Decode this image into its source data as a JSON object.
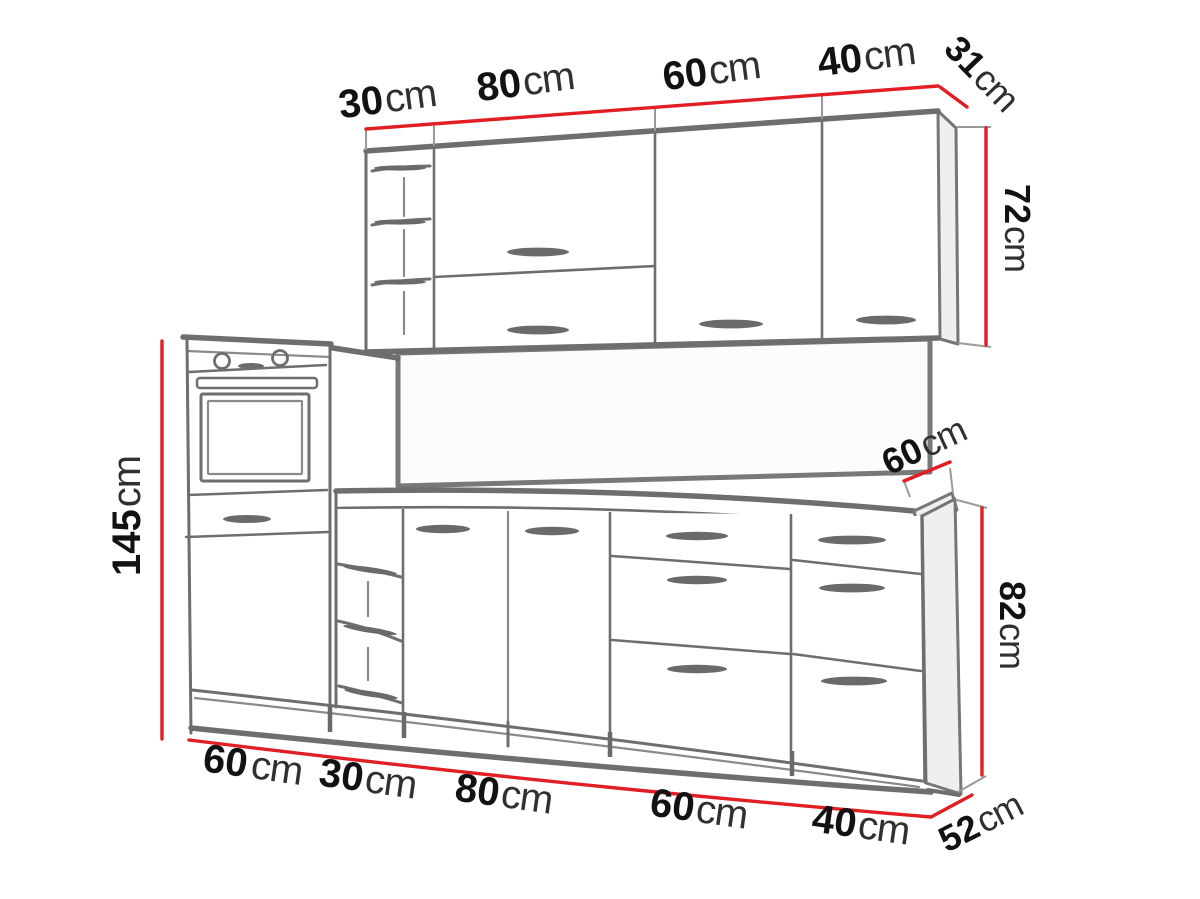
{
  "title": "Kitchen cabinet set dimension diagram",
  "colors": {
    "dimension_red": "#e01e24",
    "sketch_line": "#6e6e6e",
    "label_text": "#141414"
  },
  "dimensions": {
    "upper_row": {
      "widths_cm": [
        30,
        80,
        60,
        40
      ],
      "depth_cm": 31,
      "height_cm": 72
    },
    "tall_oven_cabinet": {
      "height_cm": 145
    },
    "base_row": {
      "widths_cm": [
        60,
        30,
        80,
        60,
        40
      ],
      "depth_cm": 52,
      "height_cm": 82,
      "worktop_depth_cm": 60
    }
  },
  "labels": {
    "upper_w1": {
      "num": "30",
      "unit": "cm"
    },
    "upper_w2": {
      "num": "80",
      "unit": "cm"
    },
    "upper_w3": {
      "num": "60",
      "unit": "cm"
    },
    "upper_w4": {
      "num": "40",
      "unit": "cm"
    },
    "upper_depth": {
      "num": "31",
      "unit": "cm"
    },
    "upper_height": {
      "num": "72",
      "unit": "cm"
    },
    "tall_height": {
      "num": "145",
      "unit": "cm"
    },
    "worktop_depth": {
      "num": "60",
      "unit": "cm"
    },
    "base_height": {
      "num": "82",
      "unit": "cm"
    },
    "base_w1": {
      "num": "60",
      "unit": "cm"
    },
    "base_w2": {
      "num": "30",
      "unit": "cm"
    },
    "base_w3": {
      "num": "80",
      "unit": "cm"
    },
    "base_w4": {
      "num": "60",
      "unit": "cm"
    },
    "base_w5": {
      "num": "40",
      "unit": "cm"
    },
    "base_depth": {
      "num": "52",
      "unit": "cm"
    }
  }
}
